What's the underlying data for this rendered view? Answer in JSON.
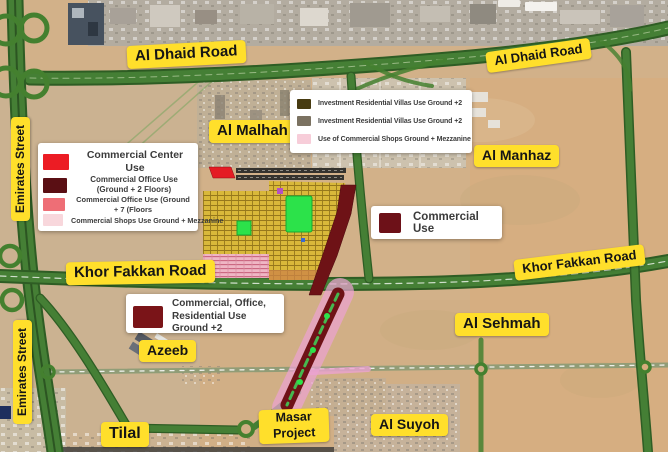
{
  "map_labels": {
    "al_dhaid_road_left": "Al Dhaid Road",
    "al_dhaid_road_right": "Al Dhaid Road",
    "al_malhah": "Al Malhah",
    "al_manhaz": "Al Manhaz",
    "emirates_street_top": "Emirates Street",
    "emirates_street_bottom": "Emirates Street",
    "khor_fakkan_road_left": "Khor Fakkan Road",
    "khor_fakkan_road_right": "Khor Fakkan Road",
    "al_sehmah": "Al Sehmah",
    "azeeb": "Azeeb",
    "tilal": "Tilal",
    "al_suyoh": "Al Suyoh",
    "masar_project_line1": "Masar",
    "masar_project_line2": "Project"
  },
  "legend_top": {
    "items": [
      {
        "label": "Investment Residential Villas Use Ground +2",
        "swatch": "#473b11"
      },
      {
        "label": "Investment Residential Villas Use Ground +2",
        "swatch": "#7b7261"
      },
      {
        "label": "Use of Commercial Shops Ground + Mezzanine",
        "swatch": "#f7cdd9"
      }
    ]
  },
  "legend_left": {
    "items": [
      {
        "label": "Commercial Center Use",
        "swatch": "#ec1c24"
      },
      {
        "label": "Commercial Office Use (Ground + 2 Floors)",
        "swatch": "#5a0f14"
      },
      {
        "label": "Commercial Office Use (Ground + 7 (Floors",
        "swatch": "#ee6e76"
      },
      {
        "label": "Commercial Shops Use Ground + Mezzanine",
        "swatch": "#f8d7dc"
      }
    ]
  },
  "legend_right": {
    "items": [
      {
        "label": "Commercial Use",
        "swatch": "#6d1118"
      }
    ]
  },
  "legend_bottom": {
    "items": [
      {
        "label": "Commercial, Office, Residential Use Ground +2",
        "swatch": "#7a1418"
      }
    ]
  },
  "map_colors": {
    "label_bg": "#ffdf2b",
    "road_green": "#44802f",
    "desert": "#d2b189",
    "plot_yellow": "#d9b83a",
    "park_green": "#2ce24a",
    "corridor_maroon": "#6e1216",
    "corridor_pink": "#eba2d1",
    "commercial_red": "#e41c24"
  }
}
